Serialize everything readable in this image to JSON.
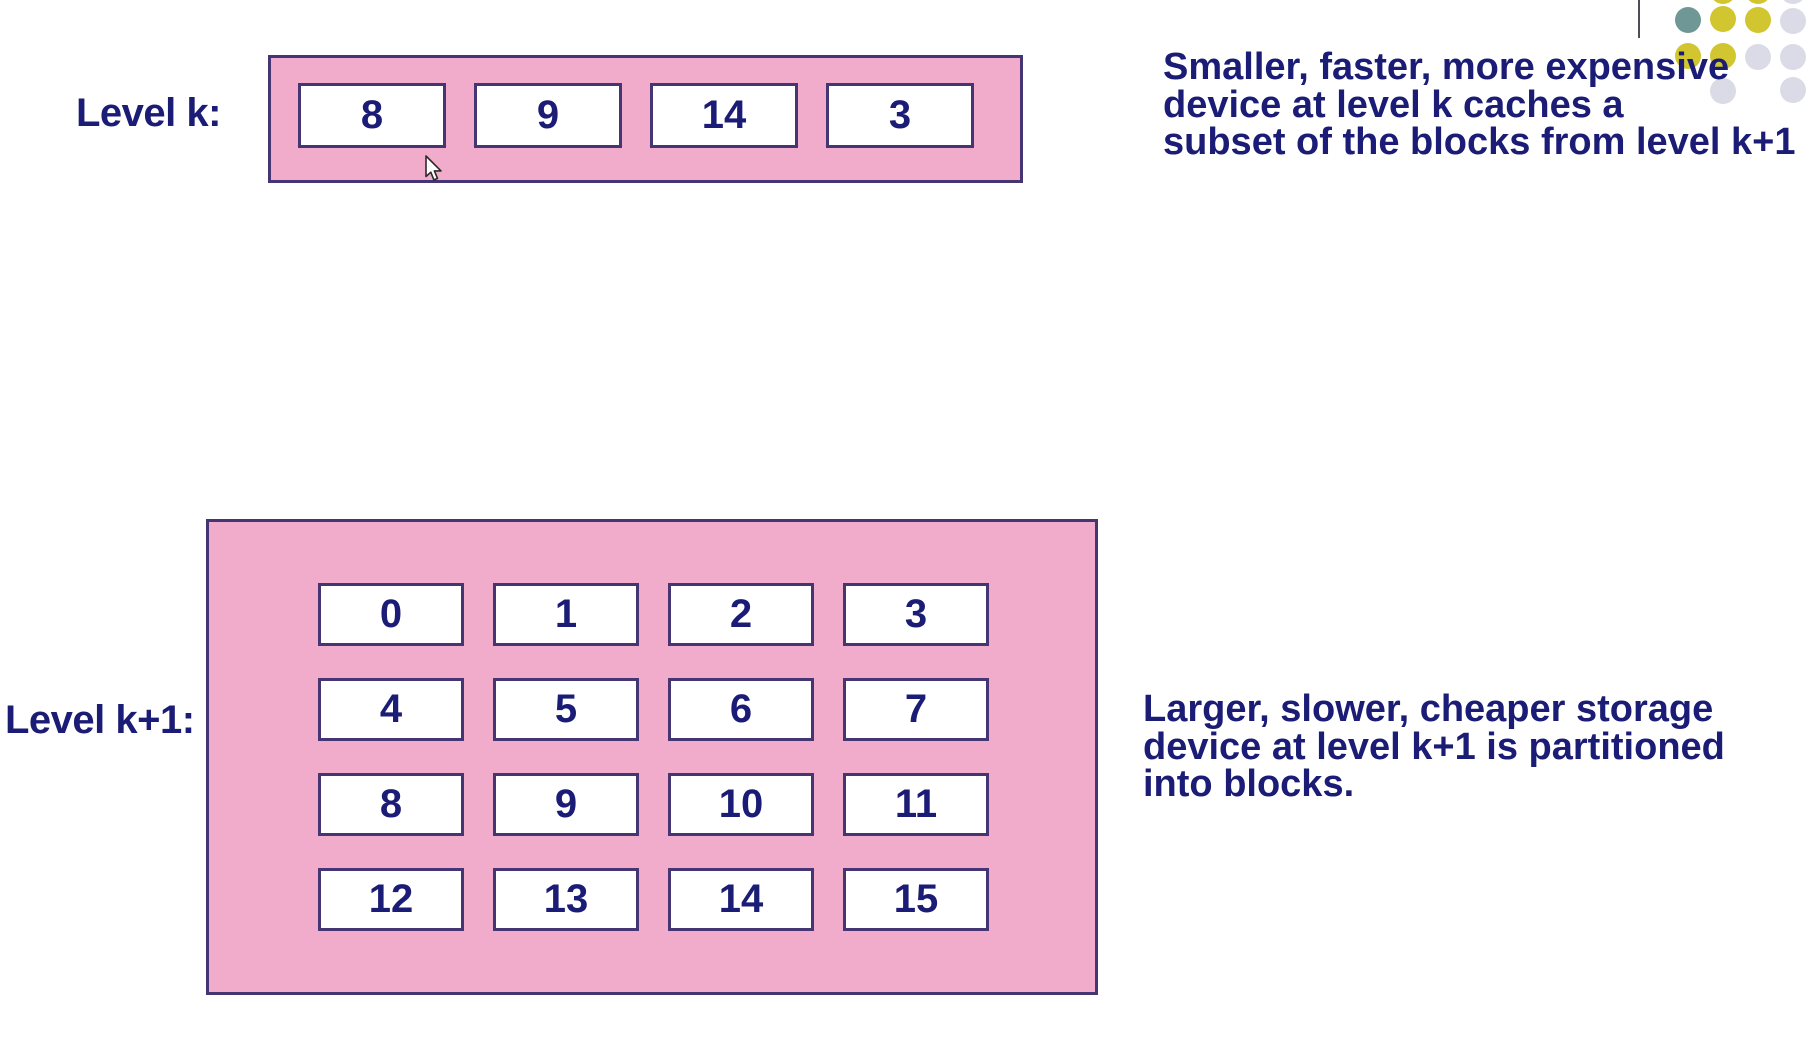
{
  "slide": {
    "level_k": {
      "label": "Level k:",
      "blocks": [
        "8",
        "9",
        "14",
        "3"
      ]
    },
    "level_k_annotation": {
      "lines": [
        "Smaller, faster, more expensive",
        "device at level k caches a",
        "subset of the blocks from level k+1"
      ]
    },
    "level_k1": {
      "label": "Level k+1:",
      "blocks": [
        "0",
        "1",
        "2",
        "3",
        "4",
        "5",
        "6",
        "7",
        "8",
        "9",
        "10",
        "11",
        "12",
        "13",
        "14",
        "15"
      ]
    },
    "level_k1_annotation": {
      "lines": [
        "Larger, slower, cheaper storage",
        "device at level k+1 is partitioned",
        "into blocks."
      ]
    }
  },
  "colors": {
    "pink_fill": "#f2accb",
    "box_border": "#453673",
    "text_navy": "#1b1c75"
  },
  "decoration": {
    "palette": {
      "teal": "#6f9795",
      "yellow": "#d1c630",
      "gray": "#dadbe6"
    },
    "line_color": "#4d4d55",
    "dots": [
      {
        "x": 1723,
        "y": -9,
        "color": "yellow"
      },
      {
        "x": 1758,
        "y": -9,
        "color": "yellow"
      },
      {
        "x": 1793,
        "y": -9,
        "color": "gray"
      },
      {
        "x": 1688,
        "y": 20,
        "color": "teal"
      },
      {
        "x": 1723,
        "y": 19,
        "color": "yellow"
      },
      {
        "x": 1758,
        "y": 20,
        "color": "yellow"
      },
      {
        "x": 1793,
        "y": 21,
        "color": "gray"
      },
      {
        "x": 1688,
        "y": 56,
        "color": "yellow"
      },
      {
        "x": 1723,
        "y": 56,
        "color": "yellow"
      },
      {
        "x": 1758,
        "y": 57,
        "color": "gray"
      },
      {
        "x": 1793,
        "y": 57,
        "color": "gray"
      },
      {
        "x": 1723,
        "y": 91,
        "color": "gray"
      },
      {
        "x": 1793,
        "y": 90,
        "color": "gray"
      }
    ]
  },
  "cursor": {
    "x": 424,
    "y": 155
  }
}
